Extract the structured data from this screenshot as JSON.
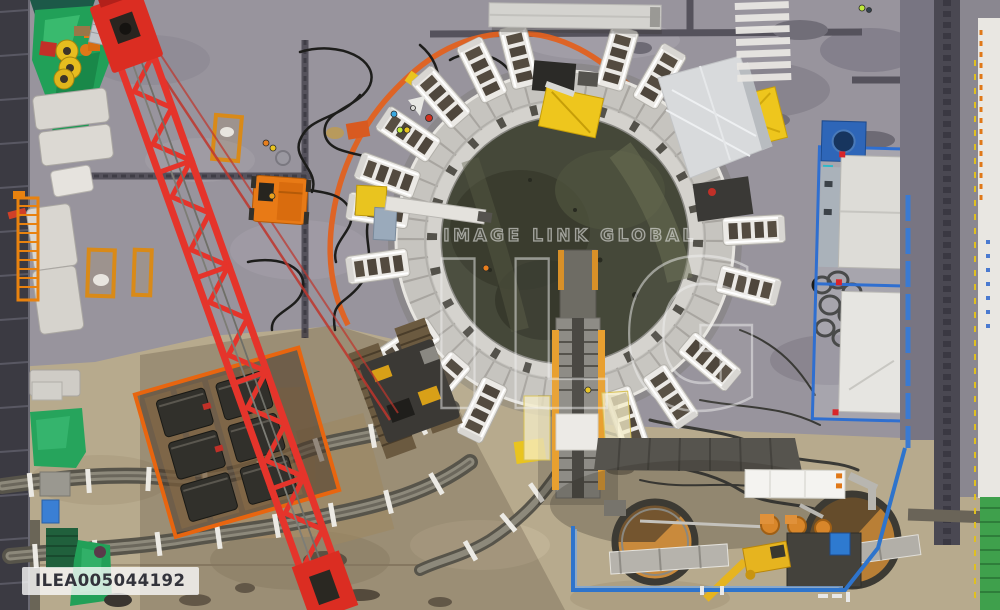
{
  "watermark": {
    "brand_text": "IMAGE LINK GLOBAL",
    "logo_text": "ILG",
    "image_id": "ILEA005044192"
  },
  "scene": {
    "alt_text": "Aerial top-down view of a circular tunnel shaft construction site: red crawler crane boom, concrete ring collar with radial jacking frames, cable bundles, blue container yard, slurry tanks and green tarpaulins"
  },
  "palette": {
    "asphalt_gray": "#98949d",
    "concrete_tan": "#b7aa8d",
    "road_dark": "#3b3a42",
    "crane_red": "#e5342b",
    "safety_orange": "#e0701c",
    "safety_yellow": "#e9c41f",
    "tarp_green": "#21a058",
    "barrier_blue": "#2e74cc",
    "ring_concrete": "#c6c4bf",
    "shaft_water": "#454839",
    "watermark_white": "#f0f0f0",
    "id_text": "#33333b"
  }
}
